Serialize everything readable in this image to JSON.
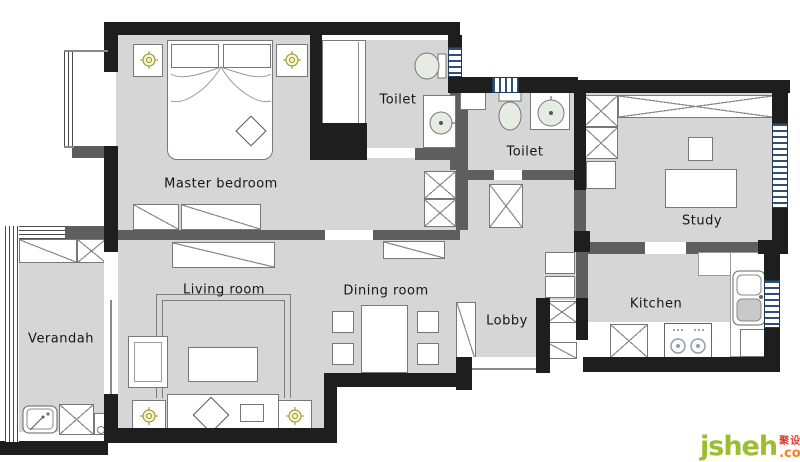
{
  "rooms": {
    "master_bedroom": "Master bedroom",
    "toilet_top": "Toilet",
    "toilet_middle": "Toilet",
    "study": "Study",
    "living_room": "Living room",
    "dining_room": "Dining room",
    "lobby": "Lobby",
    "kitchen": "Kitchen",
    "verandah": "Verandah"
  },
  "watermark": {
    "brand": "jsheh",
    "suffix": ".com",
    "cjk": "聚设汇"
  },
  "colors": {
    "exterior_wall": "#1e1e1e",
    "interior_wall": "#5e5e5e",
    "floor": "#d6d6d6",
    "window_blue": "#2f4e78",
    "lamp_gold": "#8f8f20",
    "fixture_green": "#e7ece2",
    "brand_green": "#9cbe2e",
    "brand_orange": "#f0821e",
    "brand_red": "#e23a2e"
  }
}
